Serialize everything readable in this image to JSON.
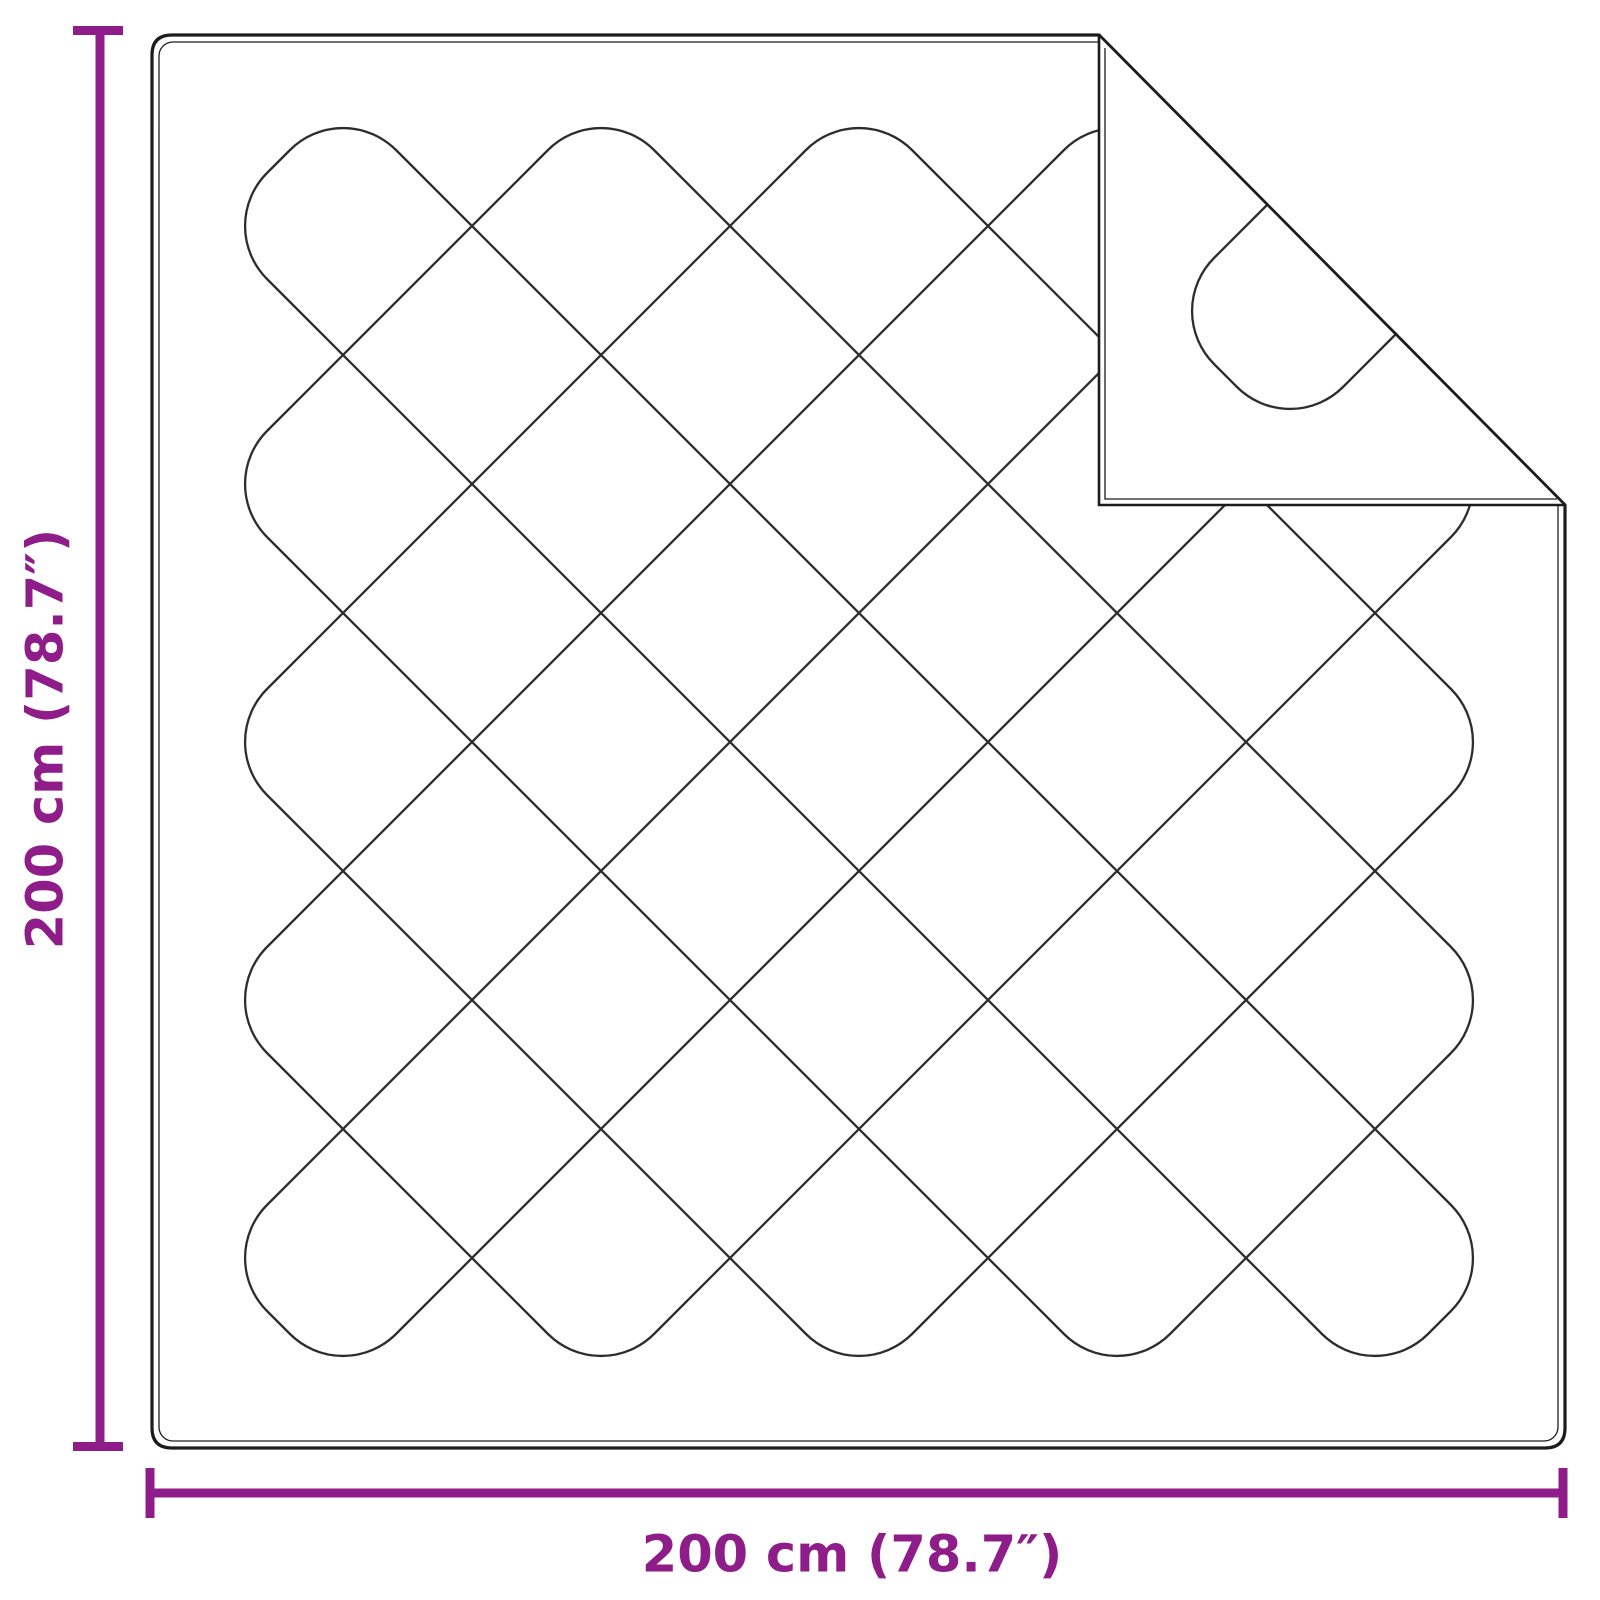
{
  "figure": {
    "name": "quilted-blanket-dimension-diagram",
    "description": "Top view line drawing of a square quilted blanket with diamond stitching and the top-right corner folded over"
  },
  "dimensions": {
    "height_label": "200 cm (78.7″)",
    "width_label": "200 cm (78.7″)"
  },
  "colors": {
    "dimension": "#8f1d89",
    "outline": "#1c1c1c",
    "pattern": "#2d2d2d",
    "background": "#ffffff"
  }
}
